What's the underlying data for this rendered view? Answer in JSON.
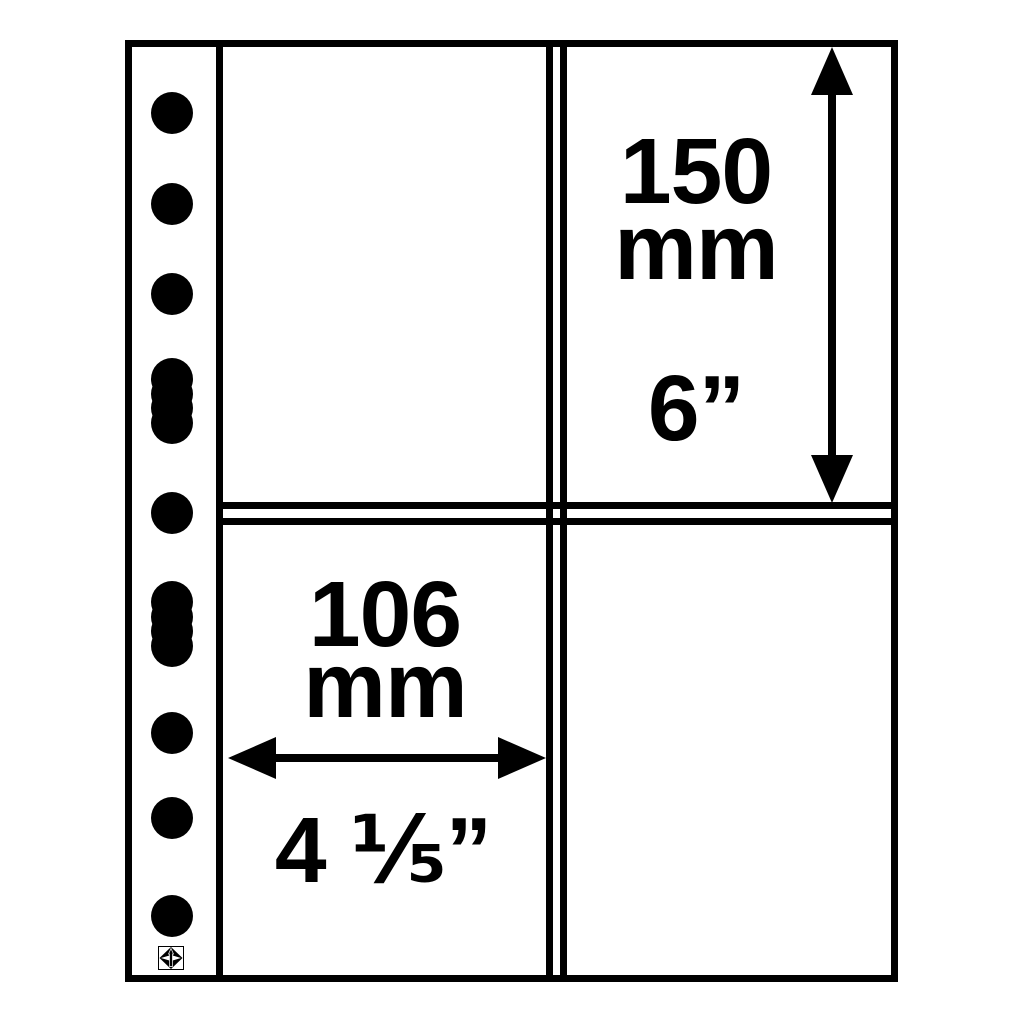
{
  "diagram": {
    "title": "pocket-sheet-dimension-diagram",
    "colors": {
      "ink": "#000000",
      "paper": "#ffffff"
    },
    "annotations": {
      "height": {
        "value": "150",
        "unit": "mm",
        "imperial": "6”"
      },
      "width": {
        "value": "106",
        "unit": "mm",
        "imperial": "4 ⅕”"
      }
    },
    "structure": {
      "pockets": 4,
      "binder_holes_round": 7,
      "binder_holes_slotted": 2
    },
    "icons": {
      "logo": "brand-compass-lighthouse-logo",
      "vertical_arrow": "double-headed-vertical-arrow",
      "horizontal_arrow": "double-headed-horizontal-arrow"
    }
  }
}
